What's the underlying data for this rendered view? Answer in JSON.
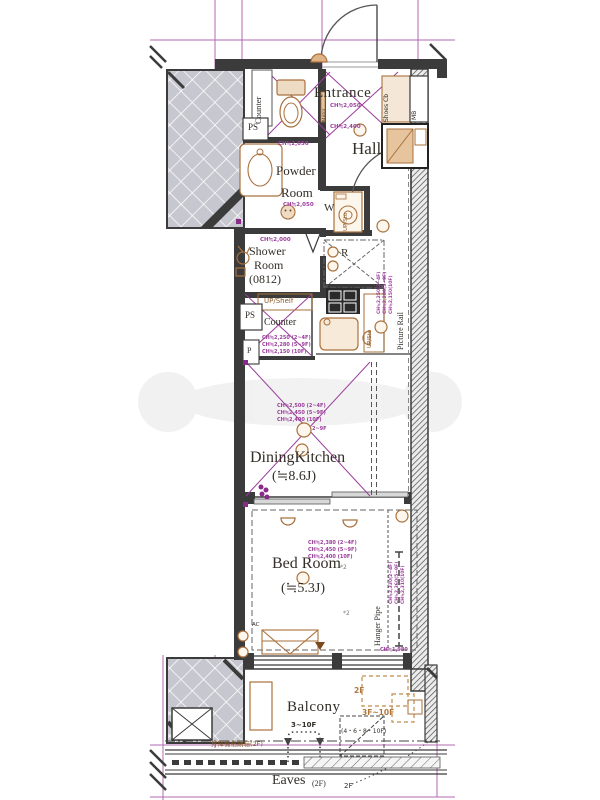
{
  "plan": {
    "rooms": {
      "entrance": "Entrance",
      "hall": "Hall",
      "powder1": "Powder",
      "powder2": "Room",
      "shower1": "Shower",
      "shower2": "Room",
      "shower_size": "(0812)",
      "dk": "DiningKitchen",
      "dk_size": "(≒8.6J)",
      "bedroom": "Bed Room",
      "bedroom_size": "(≒5.3J)",
      "balcony": "Balcony",
      "eaves": "Eaves",
      "eaves_floor": "(2F)"
    },
    "labels": {
      "counter_top": "Counter",
      "ps_top": "PS",
      "ps_mid": "PS",
      "p": "P",
      "w": "W",
      "r": "R",
      "up_sto_laundry": "UP/Sto",
      "up_shelf": "UP/Shelf",
      "counter_mid": "Counter",
      "up_sto_kitchen": "UP/Sto",
      "shoes_cb": "Shoes Cb",
      "mb": "MB",
      "mirror": "Mirror",
      "picture_rail": "Picture Rail",
      "hanger_pipe": "Hanger Pipe",
      "ac": "AC",
      "note2_a": "*2",
      "note2_b": "*2"
    },
    "ch": {
      "entrance": "CH≒2,050",
      "entrance_low": "CH≒2,400",
      "powder_top": "CH≒2,050",
      "powder_bottom": "CH≒2,050",
      "shower": "CH≒2,000",
      "kitchen": [
        "CH≒2,250 (2~4F)",
        "CH≒2,280 (5~9F)",
        "CH≒2,150 (10F)"
      ],
      "dk": [
        "CH≒2,500 (2~4F)",
        "CH≒2,450 (5~9F)",
        "CH≒2,400 (10F)"
      ],
      "dk_note": "2~9F",
      "picture_rail_v": [
        "CH≒2,250(2~4F)",
        "CH≒2,280(5~9F)",
        "CH≒2,150(10F)"
      ],
      "bedroom": [
        "CH≒2,380 (2~4F)",
        "CH≒2,450 (5~9F)",
        "CH≒2,400 (10F)"
      ],
      "closet_v": [
        "CH≒2,330(2~4F)",
        "CH≒2,360(5~9F)",
        "CH≒2,310(10F)"
      ],
      "window": "CH≒1,980"
    },
    "floors": {
      "balcony_2f": "2F",
      "balcony_3f10f": "3F~10F",
      "bracket_3_10f": "3~10F",
      "bracket_46810f": "(4・6・8・10F)",
      "elevator_box": "昇降機格納箱(2F)",
      "eaves_2f": "2F"
    },
    "colors": {
      "annotation_purple": "#9b3d9b",
      "fixture_tan": "#a9713d",
      "wall_dark": "#3b3b3b",
      "column_gray": "#c7c7cf"
    }
  }
}
